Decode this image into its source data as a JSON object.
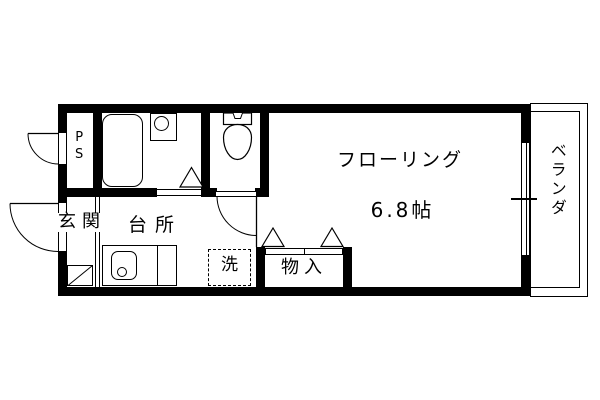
{
  "labels": {
    "ps": "PS",
    "entrance": "玄関",
    "kitchen": "台所",
    "washer": "洗",
    "closet": "物入",
    "flooring": "フローリング",
    "flooring_size": "6.8帖",
    "veranda": "ベランダ"
  },
  "colors": {
    "line": "#000000",
    "background": "#ffffff"
  }
}
